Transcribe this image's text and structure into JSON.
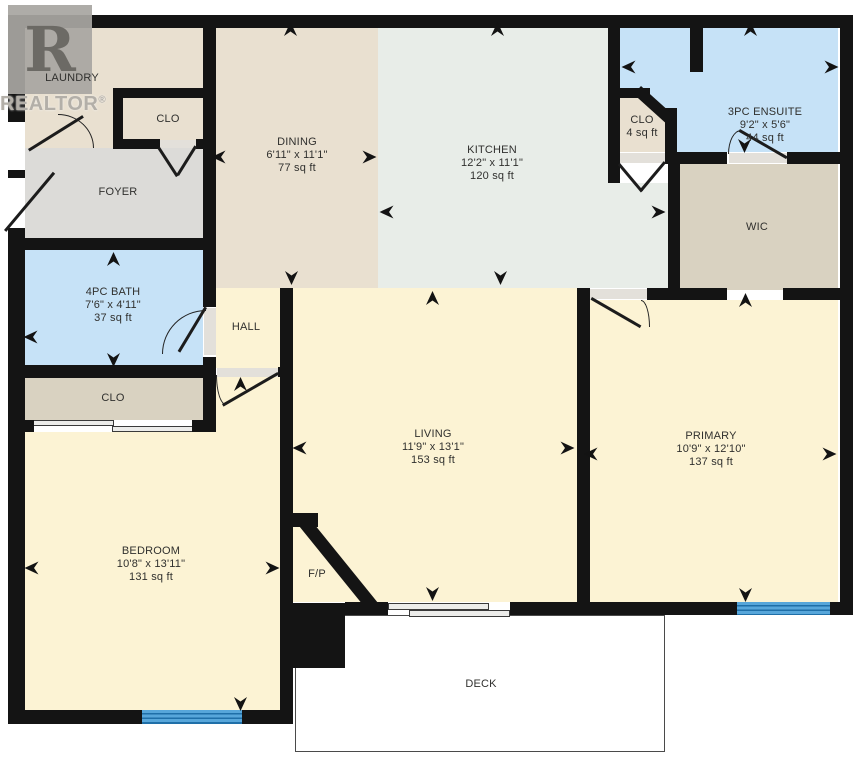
{
  "watermark": {
    "logo_letter": "R",
    "text": "REALTOR",
    "registered": "®"
  },
  "rooms": {
    "laundry": {
      "name": "LAUNDRY"
    },
    "laundry_clo": {
      "name": "CLO"
    },
    "foyer": {
      "name": "FOYER"
    },
    "dining": {
      "name": "DINING",
      "dims": "6'11\" x 11'1\"",
      "area": "77 sq ft"
    },
    "kitchen": {
      "name": "KITCHEN",
      "dims": "12'2\" x 11'1\"",
      "area": "120 sq ft"
    },
    "ensuite": {
      "name": "3PC ENSUITE",
      "dims": "9'2\" x 5'6\"",
      "area": "44 sq ft"
    },
    "kitchen_clo": {
      "name": "CLO",
      "area": "4 sq ft"
    },
    "wic": {
      "name": "WIC"
    },
    "bath": {
      "name": "4PC BATH",
      "dims": "7'6\" x 4'11\"",
      "area": "37 sq ft"
    },
    "hall": {
      "name": "HALL"
    },
    "bedroom_clo": {
      "name": "CLO"
    },
    "living": {
      "name": "LIVING",
      "dims": "11'9\" x 13'1\"",
      "area": "153 sq ft"
    },
    "primary": {
      "name": "PRIMARY",
      "dims": "10'9\" x 12'10\"",
      "area": "137 sq ft"
    },
    "bedroom": {
      "name": "BEDROOM",
      "dims": "10'8\" x 13'11\"",
      "area": "131 sq ft"
    },
    "fireplace": {
      "name": "F/P"
    },
    "deck": {
      "name": "DECK"
    }
  },
  "colors": {
    "wall": "#141414",
    "beige": "#e9e0d0",
    "kitchen_floor": "#e8ede8",
    "blue_room": "#c6e2f7",
    "yellow_room": "#fcf3d4",
    "tan_room": "#d9d2c1",
    "gray_room": "#dcdbd8",
    "window_blue": "#57a6da",
    "window_stripe": "#1f6fa8",
    "door_gap": "#e3e0da",
    "deck_outline": "#4a4a4a",
    "label_text": "#30302e",
    "watermark_gray": "#b3afa8"
  }
}
